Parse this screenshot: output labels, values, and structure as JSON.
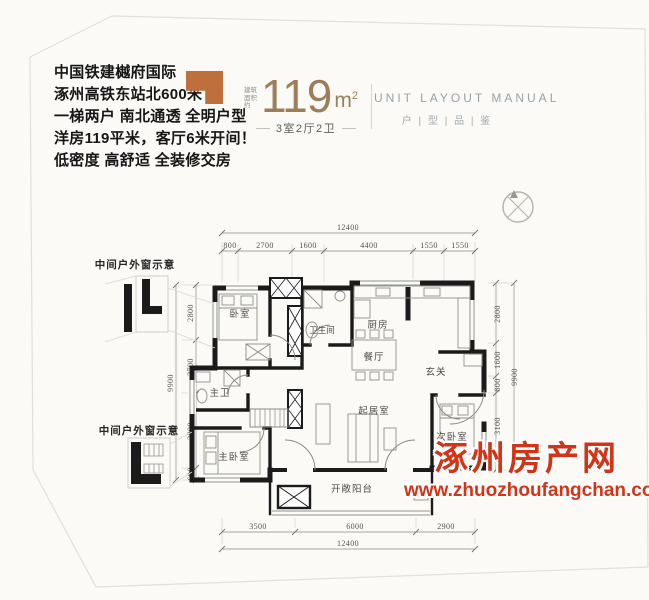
{
  "marketing": {
    "lines": [
      "中国铁建樾府国际",
      "涿州高铁东站北600米",
      "一梯两户 南北通透 全明户型",
      "洋房119平米，客厅6米开间！",
      "低密度 高舒适 全装修交房"
    ]
  },
  "area_badge": {
    "prefix": "建筑面积约",
    "value": "119",
    "unit": "m",
    "unit_sup": "2",
    "layout_text": "3室2厅2卫"
  },
  "header": {
    "title_en": "UNIT LAYOUT MANUAL",
    "title_cn": "户 | 型 | 品 | 鉴"
  },
  "sketches": {
    "top_label": "中间户外窗示意",
    "bottom_label": "中间户外窗示意"
  },
  "rooms": {
    "bedroom": "卧室",
    "bathroom": "卫生间",
    "kitchen": "厨房",
    "dining": "餐厅",
    "foyer": "玄关",
    "master_bath": "主卫",
    "master_bedroom": "主卧室",
    "living": "起居室",
    "second_bedroom": "次卧室",
    "balcony": "开敞阳台"
  },
  "dimensions": {
    "top_total": "12400",
    "top_segments": [
      "800",
      "2700",
      "1600",
      "4400",
      "1550",
      "1550"
    ],
    "bottom_segments": [
      "3500",
      "6000",
      "2900"
    ],
    "bottom_total": "12400",
    "left_segments": [
      "2800",
      "2700",
      "3800",
      "600"
    ],
    "left_total": "9900",
    "right_segments": [
      "2800",
      "1600",
      "800",
      "3100"
    ],
    "right_total": "9900"
  },
  "watermark": {
    "site_name": "涿州房产网",
    "site_url": "www.zhuozhoufangchan.com",
    "color": "#d23418"
  },
  "colors": {
    "accent_orange": "#bf6f3c",
    "area_number": "#9c7e5a",
    "header_gray": "#99a1a8",
    "wall_black": "#1b1b1b"
  }
}
